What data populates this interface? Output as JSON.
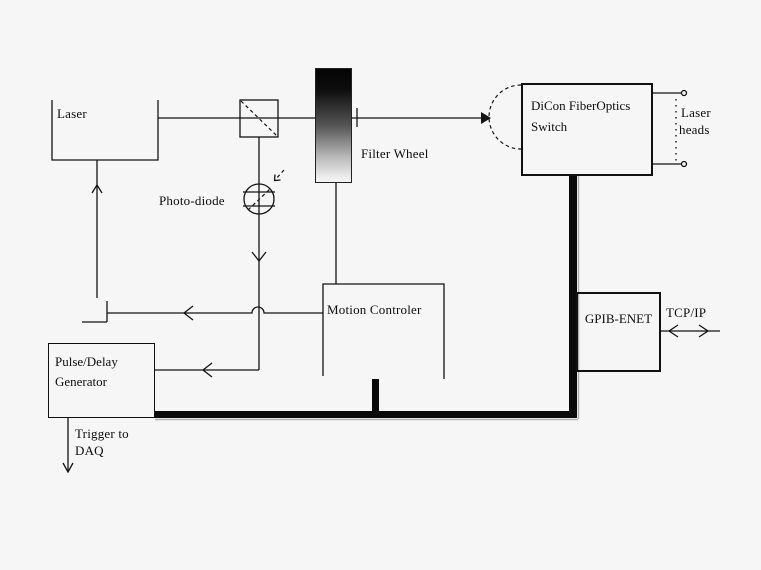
{
  "diagram": {
    "labels": {
      "laser": "Laser",
      "photodiode": "Photo-diode",
      "filter_wheel": "Filter Wheel",
      "dicon_line1": "DiCon FiberOptics",
      "dicon_line2": "Switch",
      "laser_heads_line1": "Laser",
      "laser_heads_line2": "heads",
      "motion_controller": "Motion Controler",
      "gpib_enet": "GPIB-ENET",
      "tcpip": "TCP/IP",
      "pulse_delay_line1": "Pulse/Delay",
      "pulse_delay_line2": "Generator",
      "trigger_line1": "Trigger to",
      "trigger_line2": "DAQ"
    },
    "colors": {
      "background": "#f6f6f6",
      "line": "#141414",
      "bus": "#0a0a0a",
      "filter_wheel_top": "#000000",
      "filter_wheel_bottom": "#f4f4f4"
    }
  }
}
